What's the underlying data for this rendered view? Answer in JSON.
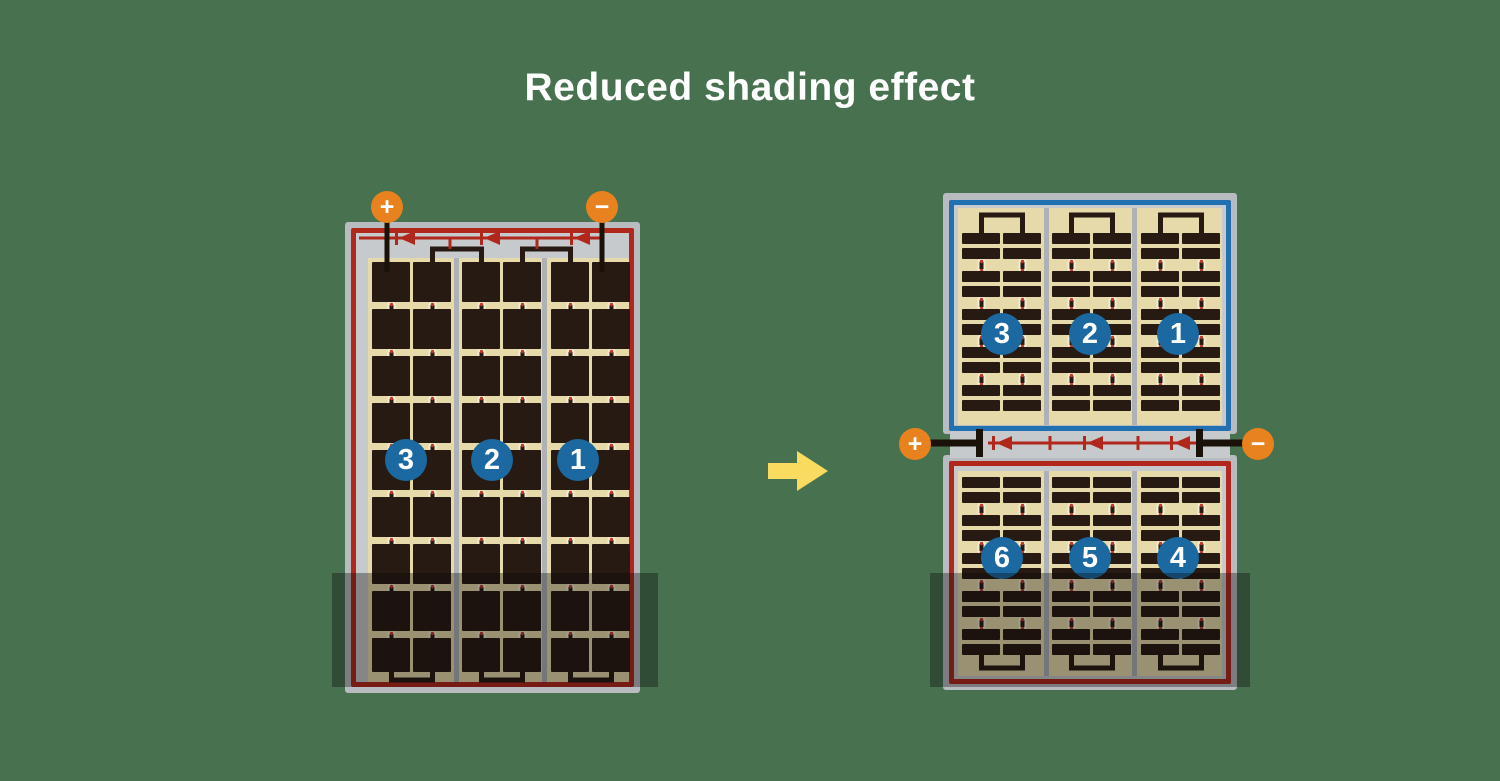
{
  "title": "Reduced shading effect",
  "arrow": {
    "icon": "arrow-right",
    "direction": "right"
  },
  "modules": {
    "before": {
      "name": "full-cell module",
      "terminals": {
        "positive": "+",
        "negative": "−"
      },
      "cell_strings": [
        {
          "label": "3"
        },
        {
          "label": "2"
        },
        {
          "label": "1"
        }
      ],
      "bypass_diodes": 3,
      "cell_grid": {
        "rows": 9,
        "columns": 6,
        "cell_type": "full"
      },
      "shaded": "bottom band across all three strings"
    },
    "after": {
      "name": "half-cut module",
      "terminals": {
        "positive": "+",
        "negative": "−"
      },
      "bypass_diodes": 3,
      "top_half": {
        "cell_strings": [
          {
            "label": "3"
          },
          {
            "label": "2"
          },
          {
            "label": "1"
          }
        ],
        "cell_grid": {
          "rows": 10,
          "columns": 6,
          "cell_type": "half-cut"
        }
      },
      "bottom_half": {
        "cell_strings": [
          {
            "label": "6"
          },
          {
            "label": "5"
          },
          {
            "label": "4"
          }
        ],
        "cell_grid": {
          "rows": 10,
          "columns": 6,
          "cell_type": "half-cut"
        }
      },
      "shaded": "bottom band of lower half only"
    }
  },
  "colors": {
    "background": "#47714f",
    "title_text": "#ffffff",
    "module_frame": "#b8bcc0",
    "backsheet": "#c7cacd",
    "cell_area": "#e6daab",
    "cell": "#271a12",
    "busbar": "#aeb2b6",
    "wire": "#1a1208",
    "circuit_red": "#b2271c",
    "circuit_blue": "#2170af",
    "string_badge_blue": "#1b69a0",
    "terminal_orange": "#e8821e",
    "connector_white": "#f3ecd2",
    "connector_red": "#c0392b",
    "arrow_yellow": "#f9db5f",
    "shade": "rgba(10,10,10,0.35)"
  }
}
